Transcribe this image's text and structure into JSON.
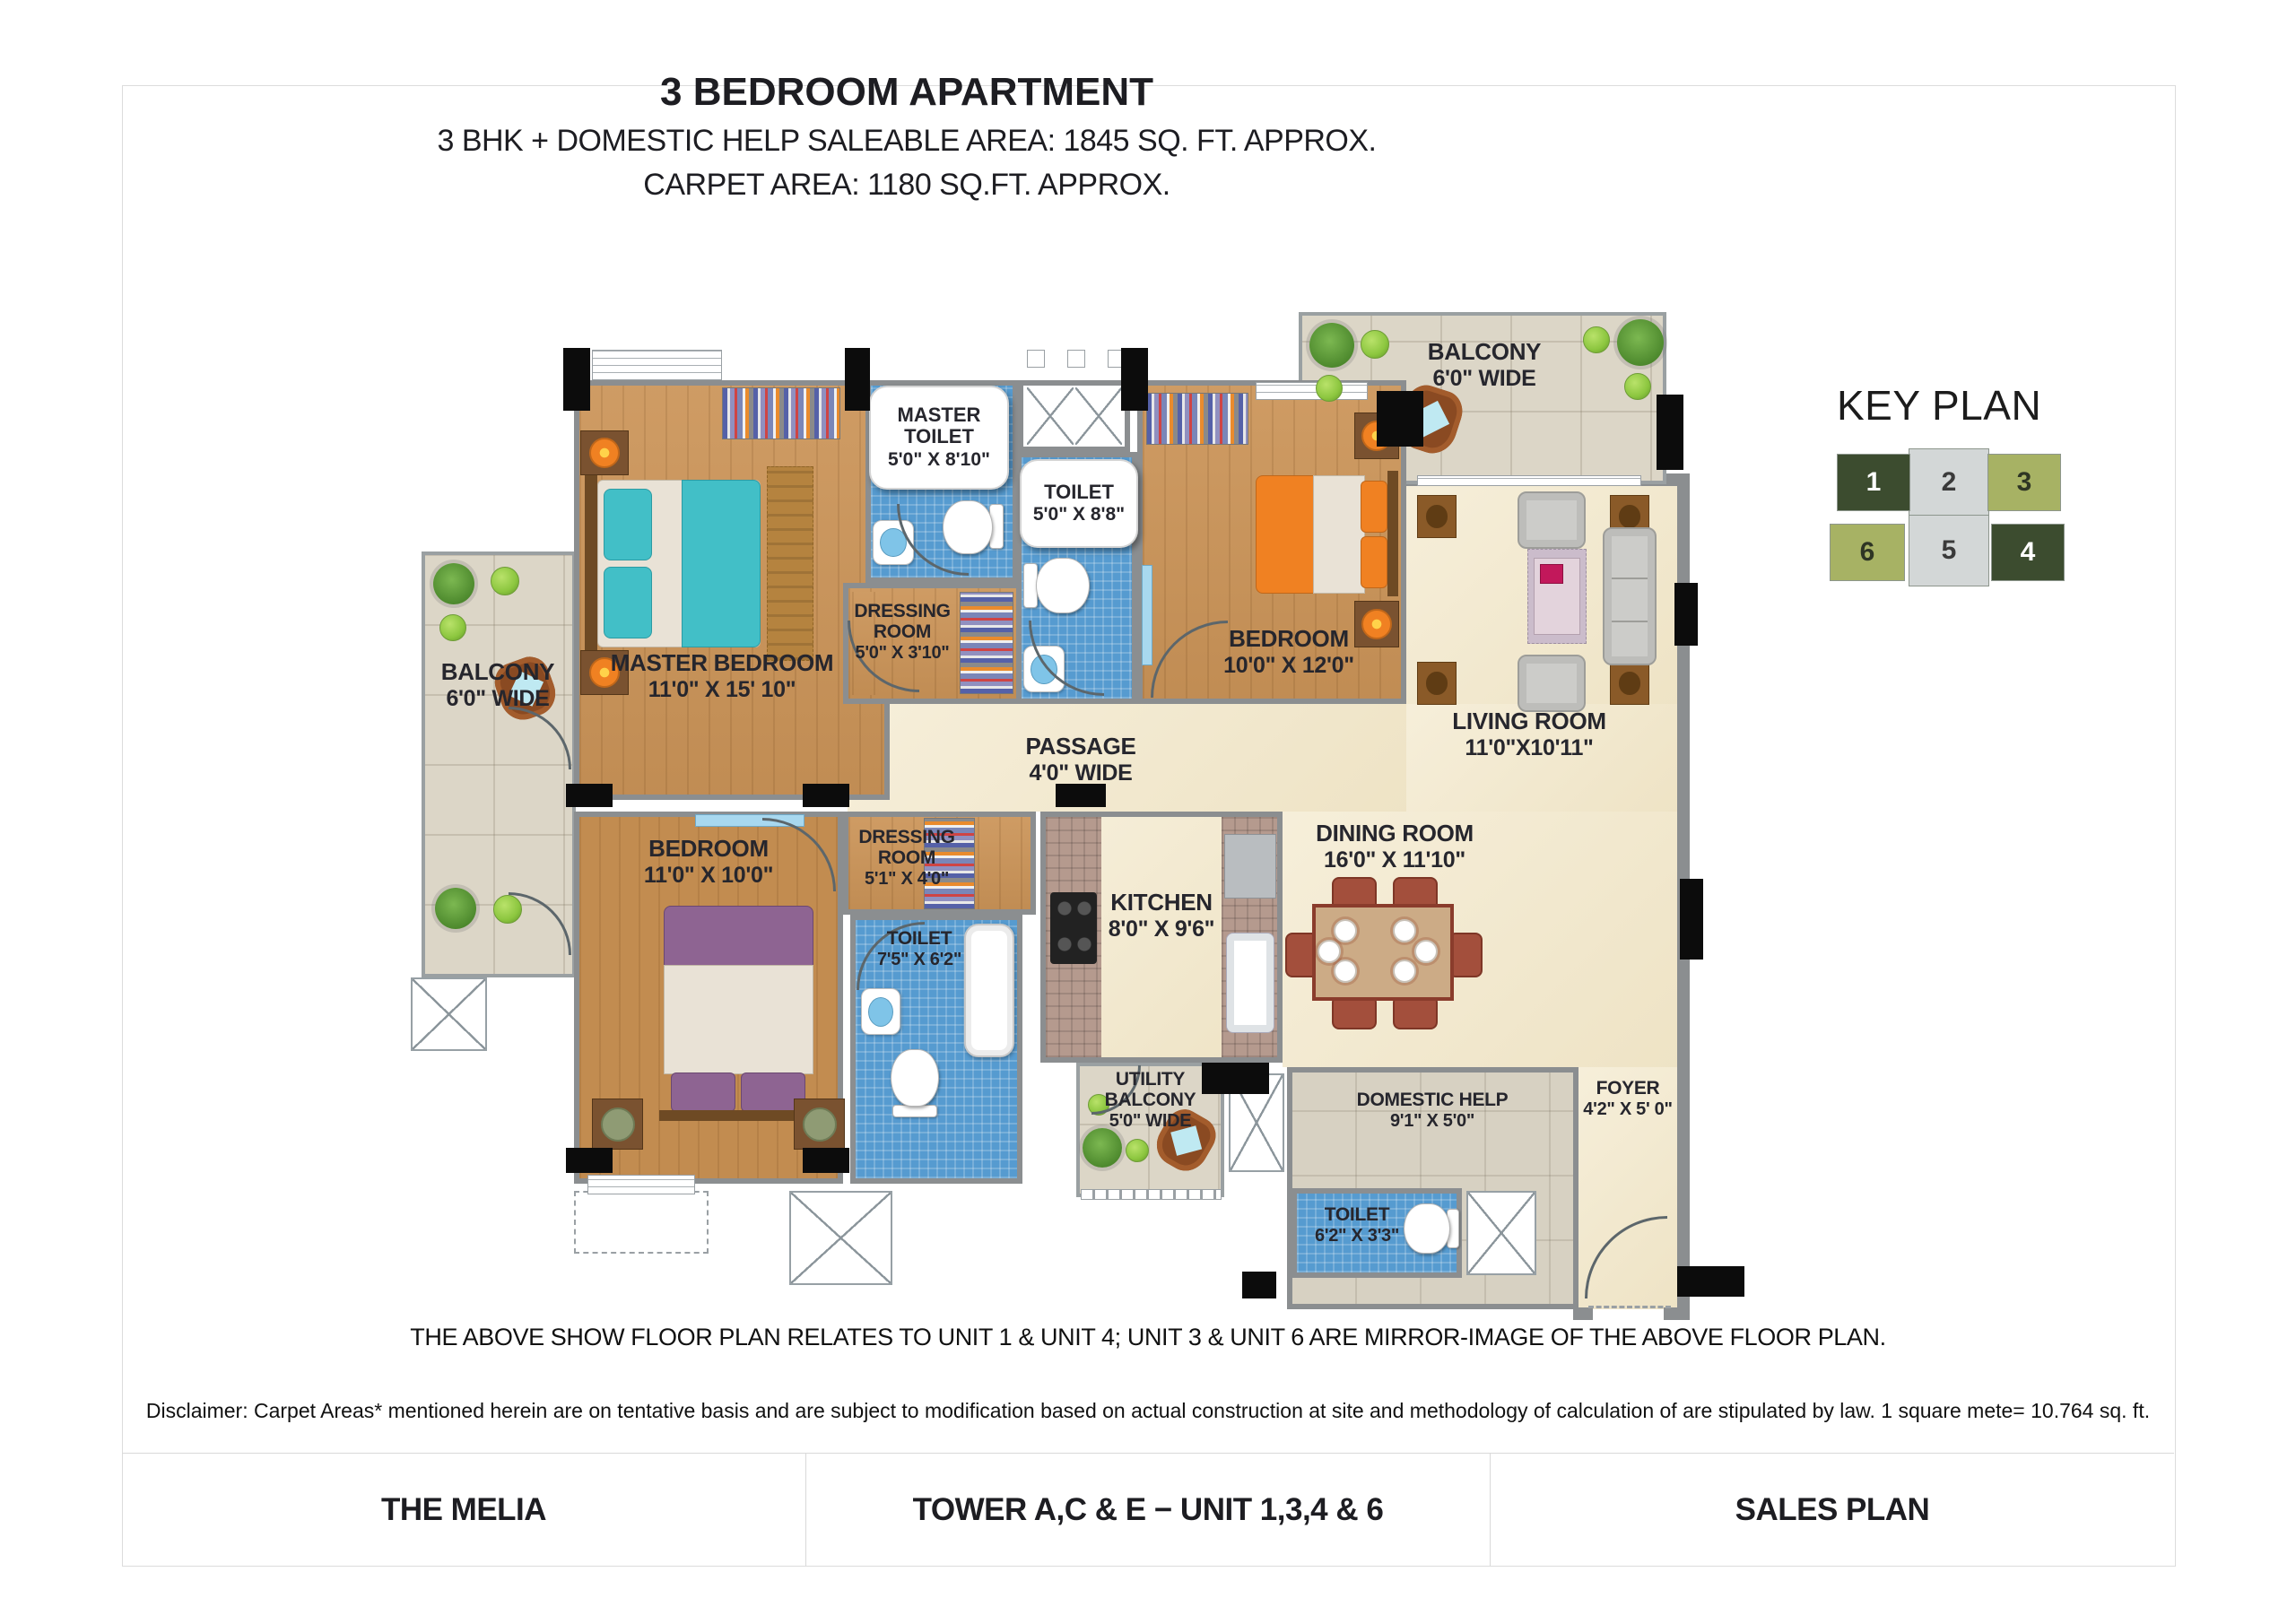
{
  "heading": {
    "title": "3 BEDROOM APARTMENT",
    "subtitle1": "3 BHK + DOMESTIC HELP SALEABLE AREA: 1845 SQ. FT. APPROX.",
    "subtitle2": "CARPET AREA: 1180 SQ.FT. APPROX."
  },
  "key_plan": {
    "title": "KEY PLAN",
    "units": [
      {
        "label": "1",
        "color": "#3c4c2f"
      },
      {
        "label": "2",
        "color": "#d3d7d7"
      },
      {
        "label": "3",
        "color": "#a7b264"
      },
      {
        "label": "6",
        "color": "#a7b264"
      },
      {
        "label": "5",
        "color": "#d3d7d7"
      },
      {
        "label": "4",
        "color": "#3c4c2f"
      }
    ]
  },
  "rooms": {
    "master_bedroom": {
      "name": "MASTER BEDROOM",
      "dims": "11'0\" X 15' 10\""
    },
    "master_toilet": {
      "name": "MASTER TOILET",
      "dims": "5'0\" X 8'10\""
    },
    "toilet_2": {
      "name": "TOILET",
      "dims": "5'0\" X 8'8\""
    },
    "dressing_1": {
      "name": "DRESSING ROOM",
      "dims": "5'0\" X 3'10\""
    },
    "bedroom_2": {
      "name": "BEDROOM",
      "dims": "10'0\" X 12'0\""
    },
    "living": {
      "name": "LIVING ROOM",
      "dims": "11'0\"X10'11\""
    },
    "balcony_top": {
      "name": "BALCONY",
      "dims": "6'0\" WIDE"
    },
    "balcony_left": {
      "name": "BALCONY",
      "dims": "6'0\" WIDE"
    },
    "passage": {
      "name": "PASSAGE",
      "dims": "4'0\" WIDE"
    },
    "bedroom_3": {
      "name": "BEDROOM",
      "dims": "11'0\" X 10'0\""
    },
    "dressing_2": {
      "name": "DRESSING ROOM",
      "dims": "5'1\" X 4'0\""
    },
    "toilet_3": {
      "name": "TOILET",
      "dims": "7'5\" X 6'2\""
    },
    "kitchen": {
      "name": "KITCHEN",
      "dims": "8'0\" X 9'6\""
    },
    "dining": {
      "name": "DINING ROOM",
      "dims": "16'0\" X 11'10\""
    },
    "utility_balcony": {
      "name": "UTILITY BALCONY",
      "dims": "5'0\" WIDE"
    },
    "domestic_help": {
      "name": "DOMESTIC HELP",
      "dims": "9'1\" X 5'0\""
    },
    "foyer": {
      "name": "FOYER",
      "dims": "4'2\" X 5' 0\""
    },
    "toilet_4": {
      "name": "TOILET",
      "dims": "6'2\" X 3'3\""
    }
  },
  "notes": {
    "note": "THE ABOVE SHOW FLOOR PLAN RELATES TO UNIT 1 & UNIT 4; UNIT 3 & UNIT 6 ARE MIRROR-IMAGE OF THE ABOVE FLOOR PLAN.",
    "disclaimer": "Disclaimer: Carpet Areas* mentioned herein are on tentative basis and are subject to modification based on actual construction at site and methodology of calculation of are stipulated by law. 1 square mete= 10.764 sq. ft."
  },
  "footer": {
    "left": "THE MELIA",
    "center": "TOWER A,C & E − UNIT 1,3,4 & 6",
    "right": "SALES PLAN"
  },
  "colors": {
    "wood_floor": "#cb9458",
    "blue_tile": "#569bd0",
    "stone_balcony": "#dcd6c7",
    "cream_marble": "#f3e9cd",
    "wall_gray": "#8b8e90",
    "accent_teal": "#42bfc7",
    "accent_orange": "#f08122",
    "accent_purple": "#8e6492"
  }
}
